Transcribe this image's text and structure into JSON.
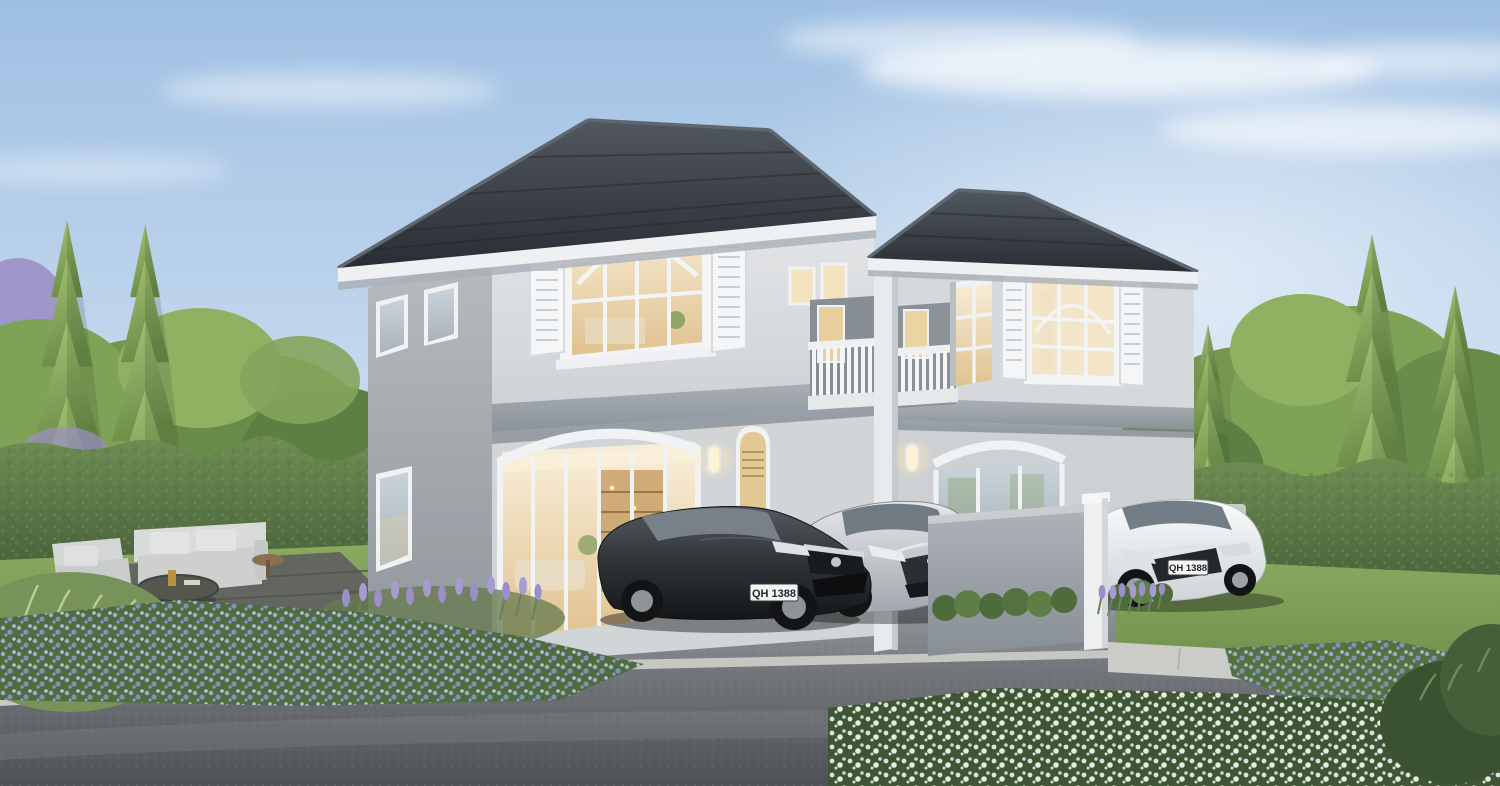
{
  "scene": {
    "description": "Daytime architectural rendering of a two-storey light-grey duplex house with dark hip roofs, arched window shutters, warm-lit interiors, balconies, a driveway with three parked sedans, conifer trees, hedges, an outdoor sofa set and flower beds along an asphalt road."
  },
  "vehicles": [
    {
      "name": "dark-grey-hatchback",
      "license_plate": "QH 1388"
    },
    {
      "name": "silver-sedan"
    },
    {
      "name": "white-sedan",
      "license_plate": "QH 1388"
    }
  ],
  "palette": {
    "sky_top": "#a3c2e4",
    "sky_horizon": "#edf3f8",
    "roof": "#34393f",
    "wall_light": "#d9dbdd",
    "wall_shade": "#9aa0a5",
    "trim_white": "#f2f4f5",
    "interior_glow": "#f0e2c0",
    "foliage": "#74964f",
    "hedge": "#55713f",
    "road": "#5f6368",
    "flowers_blue": "#8fa3cc",
    "flowers_white": "#eef2ee",
    "lavender": "#9c8fc9"
  }
}
